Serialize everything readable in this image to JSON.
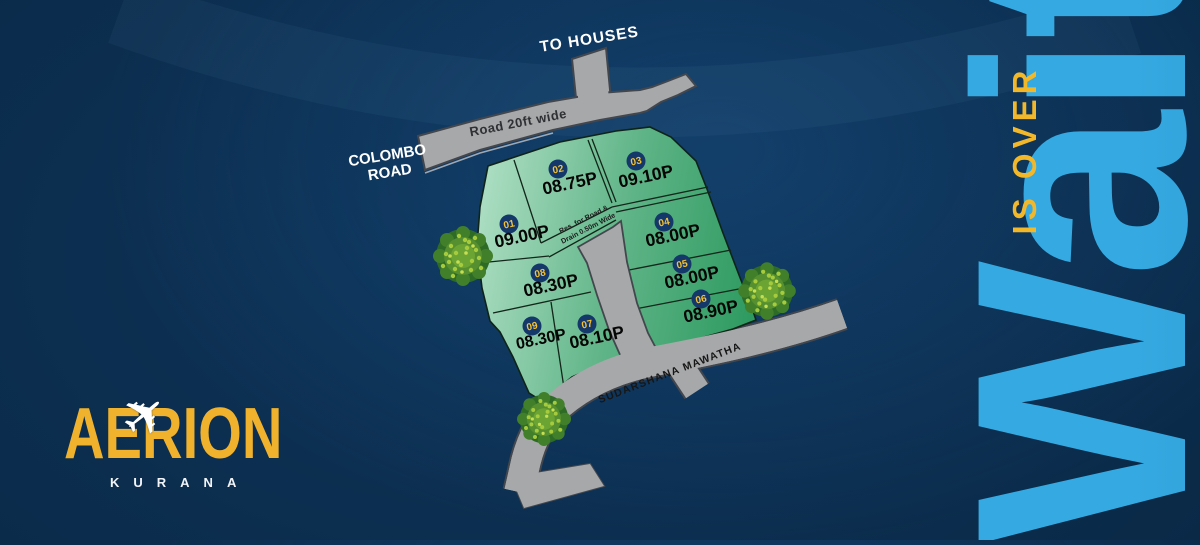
{
  "tagline": {
    "word": "Wait",
    "phrase": "IS OVER"
  },
  "logo": {
    "brand": "AERION",
    "location": "KURANA"
  },
  "map": {
    "road_labels": {
      "top": "Road 20ft wide",
      "to_houses": "TO HOUSES",
      "colombo_line1": "COLOMBO",
      "colombo_line2": "ROAD",
      "bottom": "SUDARSHANA MAWATHA"
    },
    "reservation": {
      "line1": "Res. for Road &",
      "line2": "Drain 0.50m Wide"
    },
    "plots": [
      {
        "number": "01",
        "size": "09.00P"
      },
      {
        "number": "02",
        "size": "08.75P"
      },
      {
        "number": "03",
        "size": "09.10P"
      },
      {
        "number": "04",
        "size": "08.00P"
      },
      {
        "number": "05",
        "size": "08.00P"
      },
      {
        "number": "06",
        "size": "08.90P"
      },
      {
        "number": "07",
        "size": "08.10P"
      },
      {
        "number": "08",
        "size": "08.30P"
      },
      {
        "number": "09",
        "size": "08.30P"
      }
    ]
  },
  "colors": {
    "accent_yellow": "#f2b62b",
    "wait_blue_light": "#35aae2",
    "wait_blue_dark": "#2a74b0",
    "plot_green_light": "#a9dcc0",
    "plot_green_dark": "#2d9a60",
    "road_gray": "#a7a8aa",
    "background_navy": "#0a2947",
    "badge_navy": "#15386b",
    "tree_green": "#6ca434"
  }
}
